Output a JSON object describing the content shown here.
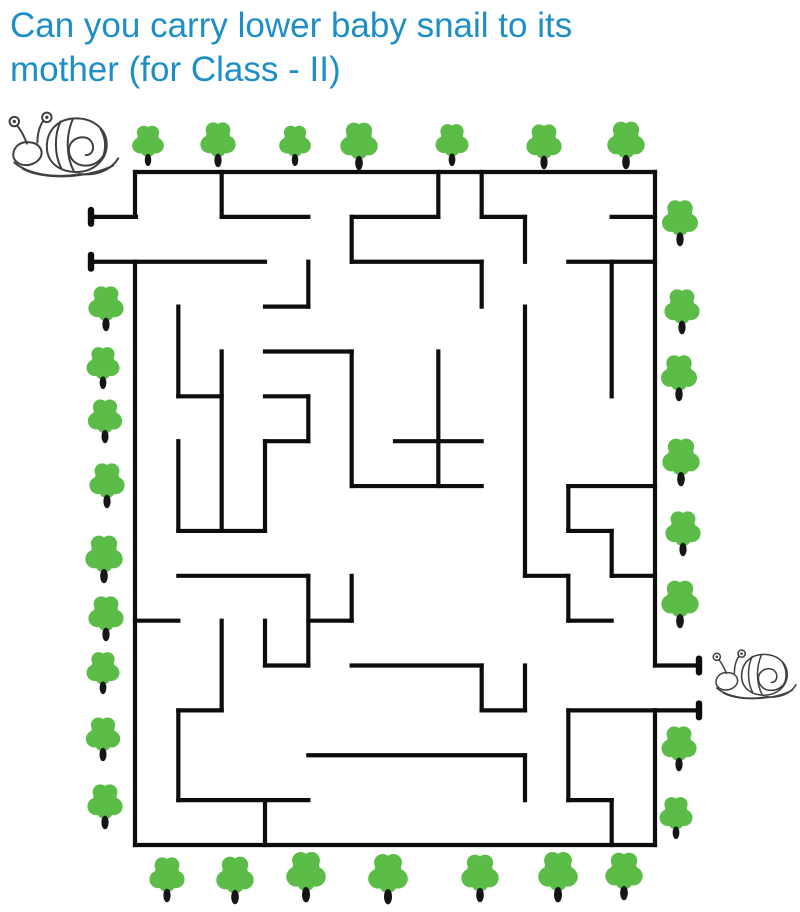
{
  "title": {
    "line1": "Can you carry lower baby snail to its",
    "line2": "mother (for Class - II)",
    "color": "#1e8fc6"
  },
  "page": {
    "background": "#ffffff"
  },
  "maze": {
    "wall_color": "#0d0d0d",
    "wall_width": 4.2,
    "grid": {
      "x0": 135,
      "y0": 172,
      "cell_w": 43.333,
      "cell_h": 44.867,
      "cols": 12,
      "rows": 15
    },
    "h_walls": [
      [
        0,
        0,
        12
      ],
      [
        1,
        2,
        4
      ],
      [
        1,
        5,
        7
      ],
      [
        1,
        8,
        9
      ],
      [
        1,
        11,
        12
      ],
      [
        2,
        5,
        8
      ],
      [
        2,
        10,
        12
      ],
      [
        3,
        3,
        4
      ],
      [
        4,
        3,
        5
      ],
      [
        5,
        1,
        2
      ],
      [
        5,
        3,
        4
      ],
      [
        6,
        3,
        4
      ],
      [
        6,
        6,
        8
      ],
      [
        7,
        5,
        8
      ],
      [
        7,
        10,
        12
      ],
      [
        8,
        1,
        3
      ],
      [
        8,
        10,
        11
      ],
      [
        9,
        1,
        4
      ],
      [
        9,
        9,
        10
      ],
      [
        9,
        11,
        12
      ],
      [
        10,
        0,
        1
      ],
      [
        10,
        4,
        5
      ],
      [
        10,
        10,
        11
      ],
      [
        11,
        3,
        4
      ],
      [
        11,
        5,
        8
      ],
      [
        12,
        1,
        2
      ],
      [
        12,
        8,
        9
      ],
      [
        12,
        10,
        12
      ],
      [
        13,
        4,
        9
      ],
      [
        14,
        1,
        4
      ],
      [
        14,
        10,
        11
      ],
      [
        15,
        0,
        12
      ]
    ],
    "v_walls": [
      [
        0,
        0,
        1
      ],
      [
        0,
        2,
        15
      ],
      [
        12,
        0,
        11
      ],
      [
        12,
        12,
        15
      ],
      [
        2,
        0,
        1
      ],
      [
        7,
        0,
        1
      ],
      [
        8,
        0,
        1
      ],
      [
        5,
        1,
        2
      ],
      [
        9,
        1,
        2
      ],
      [
        4,
        2,
        3
      ],
      [
        8,
        2,
        3
      ],
      [
        11,
        2,
        5
      ],
      [
        1,
        3,
        5
      ],
      [
        9,
        3,
        9
      ],
      [
        2,
        4,
        8
      ],
      [
        5,
        4,
        7
      ],
      [
        7,
        4,
        7
      ],
      [
        4,
        5,
        6
      ],
      [
        1,
        6,
        8
      ],
      [
        3,
        6,
        8
      ],
      [
        10,
        7,
        8
      ],
      [
        11,
        8,
        9
      ],
      [
        4,
        9,
        11
      ],
      [
        5,
        9,
        10
      ],
      [
        10,
        9,
        10
      ],
      [
        3,
        10,
        11
      ],
      [
        2,
        10,
        12
      ],
      [
        1,
        12,
        14
      ],
      [
        8,
        11,
        12
      ],
      [
        9,
        11,
        12
      ],
      [
        10,
        12,
        14
      ],
      [
        9,
        13,
        14
      ],
      [
        11,
        14,
        15
      ],
      [
        3,
        14,
        15
      ]
    ],
    "arms": [
      {
        "name": "maze-entrance-arm-top",
        "j": 1,
        "x1": 91,
        "x2": 136,
        "cap_x": 91
      },
      {
        "name": "maze-entrance-arm-bottom",
        "j": 2,
        "x1": 91,
        "x2": 265,
        "cap_x": 91
      },
      {
        "name": "maze-exit-arm-top",
        "j": 11,
        "x1": 655,
        "x2": 699,
        "cap_x": 699
      },
      {
        "name": "maze-exit-arm-bottom",
        "j": 12,
        "x1": 655,
        "x2": 699,
        "cap_x": 699
      }
    ]
  },
  "trees": {
    "canopy_color": "#5cbc48",
    "trunk_color": "#151515",
    "top_row": [
      [
        150,
        165,
        0.72
      ],
      [
        218,
        166,
        0.8
      ],
      [
        293,
        165,
        0.72
      ],
      [
        360,
        169,
        0.85
      ],
      [
        451,
        165,
        0.75
      ],
      [
        546,
        168,
        0.8
      ],
      [
        626,
        168,
        0.85
      ]
    ],
    "bottom_row": [
      [
        165,
        901,
        0.8
      ],
      [
        236,
        903,
        0.85
      ],
      [
        305,
        901,
        0.9
      ],
      [
        390,
        903,
        0.9
      ],
      [
        480,
        901,
        0.85
      ],
      [
        556,
        901,
        0.9
      ],
      [
        625,
        899,
        0.85
      ]
    ],
    "left_col": [
      [
        105,
        330,
        0.8
      ],
      [
        105,
        388,
        0.75
      ],
      [
        105,
        442,
        0.78
      ],
      [
        105,
        507,
        0.8
      ],
      [
        105,
        582,
        0.85
      ],
      [
        105,
        640,
        0.8
      ],
      [
        105,
        693,
        0.75
      ],
      [
        103,
        760,
        0.78
      ],
      [
        103,
        828,
        0.8
      ]
    ],
    "right_col": [
      [
        681,
        245,
        0.82
      ],
      [
        681,
        333,
        0.8
      ],
      [
        681,
        400,
        0.82
      ],
      [
        681,
        485,
        0.85
      ],
      [
        681,
        555,
        0.8
      ],
      [
        681,
        627,
        0.85
      ],
      [
        678,
        770,
        0.8
      ],
      [
        678,
        838,
        0.75
      ]
    ]
  },
  "snails": {
    "stroke_color": "#404040",
    "mother": {
      "x": 8,
      "y": 110,
      "scale": 1.05,
      "label": "mother snail"
    },
    "baby": {
      "x": 712,
      "y": 648,
      "scale": 0.8,
      "label": "baby snail"
    }
  }
}
